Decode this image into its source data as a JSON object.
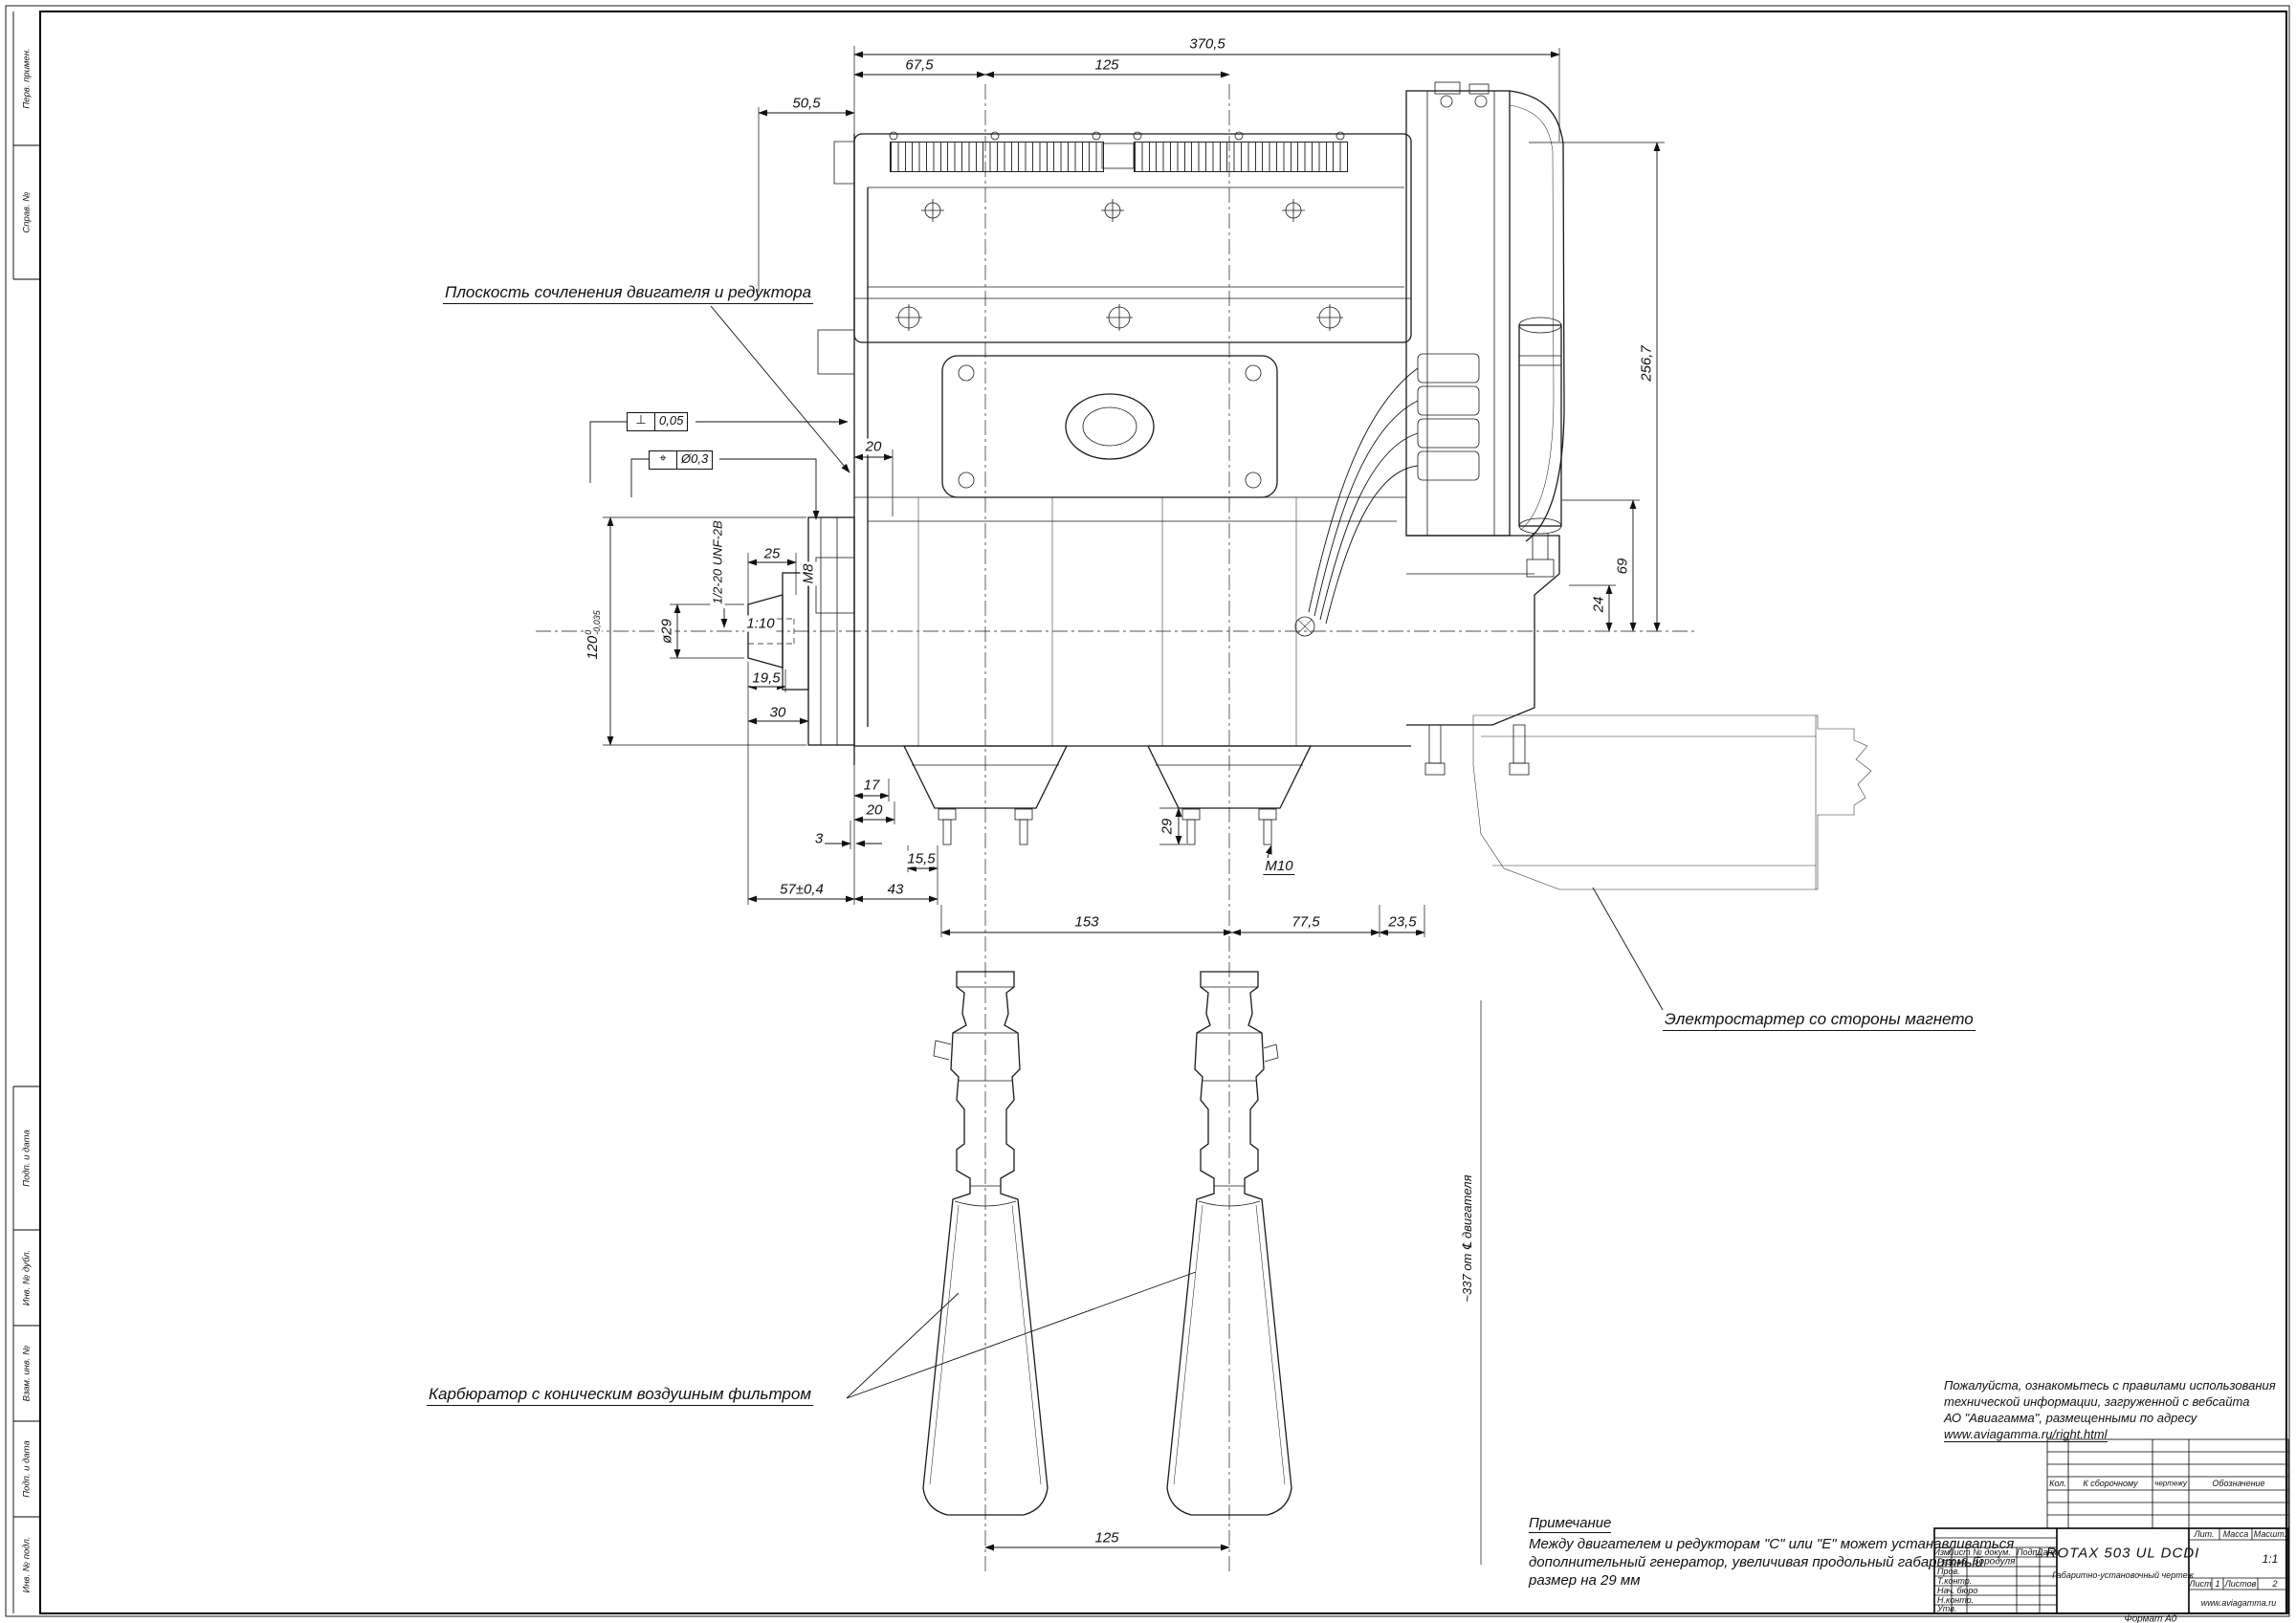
{
  "annotations": {
    "plane": "Плоскость сочленения двигателя и редуктора",
    "starter": "Электростартер со стороны магнето",
    "carburetor": "Карбюратор с коническим воздушным фильтром",
    "offset_note": "~337 от ℄ двигателя"
  },
  "dimensions": {
    "overall_width": "370,5",
    "cyl1_offset": "67,5",
    "cyl_spacing_top": "125",
    "reducer_plane": "50,5",
    "flange_20": "20",
    "thread_m8": "М8",
    "shaft_thread": "1/2-20 UNF-2B",
    "taper_len": "25",
    "shaft_dia": "ø29",
    "taper": "1:10",
    "d19_5": "19,5",
    "d30": "30",
    "flange_dia": {
      "value": "120",
      "upper": "0",
      "lower": "-0,035"
    },
    "d17": "17",
    "d20b": "20",
    "d3": "3",
    "d15_5": "15,5",
    "d57": "57±0,4",
    "d43": "43",
    "d153": "153",
    "d77_5": "77,5",
    "d23_5": "23,5",
    "stud_29": "29",
    "stud_m10": "M10",
    "h256_7": "256,7",
    "h69": "69",
    "h24": "24",
    "carb_spacing": "125"
  },
  "tolerances": {
    "perp": {
      "symbol": "⊥",
      "value": "0,05"
    },
    "pos": {
      "symbol": "⌖",
      "value": "Ø0,3"
    }
  },
  "note": {
    "title": "Примечание",
    "line1": "Между двигателем и редукторам \"С\" или \"Е\" может устанавливаться",
    "line2": "дополнительный генератор, увеличивая продольный габаритный",
    "line3": "размер на 29 мм"
  },
  "info": {
    "line1": "Пожалуйста, ознакомьтесь с правилами использования",
    "line2": "технической информации, загруженной с вебсайта",
    "line3": "АО \"Авиагамма\", размещенными по адресу",
    "url": "www.aviagamma.ru/right.html"
  },
  "title_block": {
    "doc_title": "ROTAX 503 UL DCDI",
    "doc_type": "Габаритно-установочный чертеж",
    "hdr_izm": "Изм.",
    "hdr_list": "Лист",
    "hdr_ndoc": "№ докум.",
    "hdr_podp": "Подп.",
    "hdr_data": "Дата",
    "razrab": "Разраб.",
    "razrab_name": "Бородуля",
    "prov": "Пров.",
    "tkontr": "Т.контр.",
    "nachburo": "Нач. бюро",
    "nkontr": "Н.контр.",
    "utv": "Утв.",
    "lit": "Лит.",
    "massa": "Масса",
    "masshtab": "Масшт.",
    "scale": "1:1",
    "list_label": "Лист",
    "list_num": "1",
    "listov_label": "Листов",
    "listov_num": "2",
    "site": "www.aviagamma.ru",
    "format": "Формат А0",
    "cont_kol": "Кол.",
    "cont_ksbor": "К сборочному",
    "cont_chert": "чертежу",
    "cont_obozn": "Обозначение"
  },
  "frame_stamps": {
    "perv": "Перв. примен.",
    "sprav": "Справ. №",
    "podp1": "Подп. и дата",
    "inv_dubl": "Инв. № дубл.",
    "vzam": "Взам. инв. №",
    "podp2": "Подп. и дата",
    "inv_podl": "Инв. № подл."
  }
}
